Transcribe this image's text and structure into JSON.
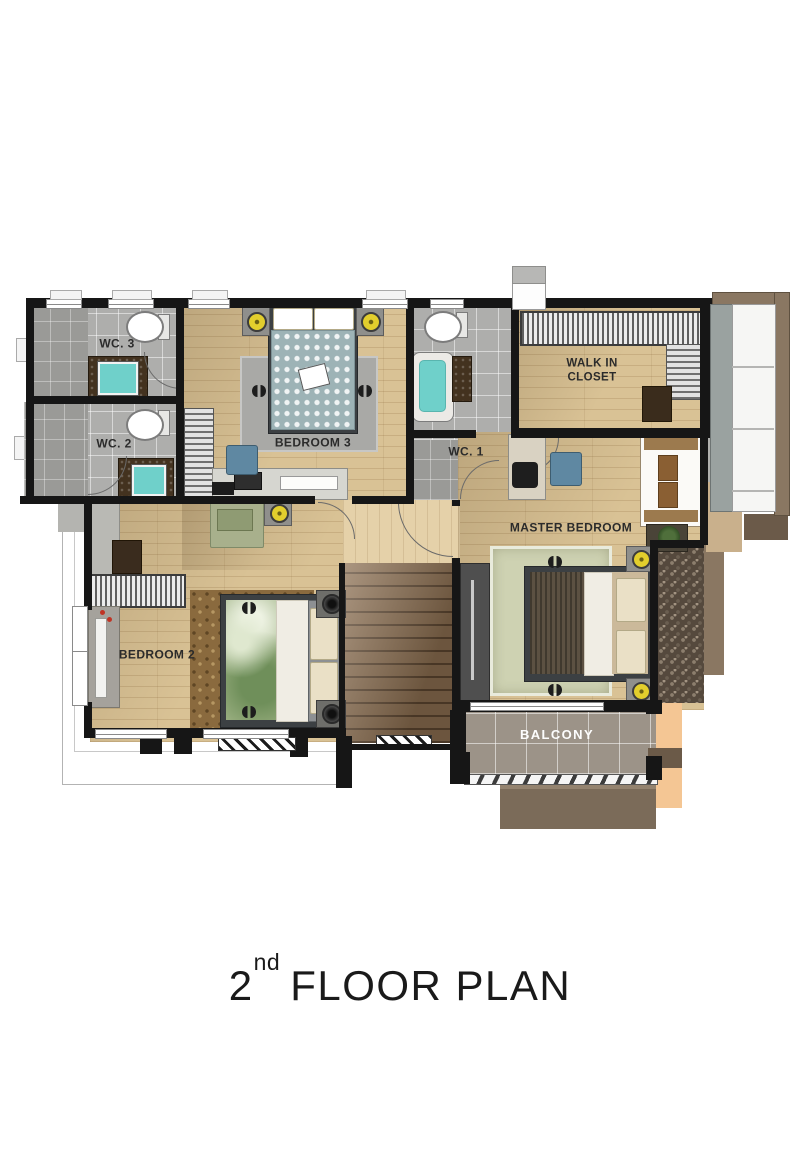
{
  "title": {
    "number": "2",
    "ordinal": "nd",
    "text": "FLOOR PLAN"
  },
  "rooms": {
    "wc3": {
      "label": "WC. 3"
    },
    "wc2": {
      "label": "WC. 2"
    },
    "bedroom3": {
      "label": "BEDROOM 3"
    },
    "wc1": {
      "label": "WC. 1"
    },
    "walk_in_closet": {
      "label": "WALK IN\nCLOSET"
    },
    "master_bedroom": {
      "label": "MASTER BEDROOM"
    },
    "bedroom2": {
      "label": "BEDROOM 2"
    },
    "balcony": {
      "label": "BALCONY"
    }
  },
  "colors": {
    "wall": "#161616",
    "wood_floor": "#d9c295",
    "wood_light": "#e5d1a9",
    "tile_gray": "#aeaeac",
    "sink_teal": "#6fd0ca",
    "vanity_brown": "#43321f",
    "duvet_teal": "#9db3b6",
    "duvet_brown": "#5c5142",
    "duvet_green": "#9eb284",
    "rug_gray": "#a9a9a6",
    "rug_sage": "#ced2b2",
    "rug_brown": "#8a6a3e",
    "speaker_yellow": "#e2ce2d",
    "stair_brown": "#8a6d4f",
    "balcony_tile": "#9c9388",
    "roof_brown": "#7b6b59",
    "peach": "#f4c694",
    "bay_frame_brown": "#8a7762",
    "chair_blue": "#5f88a2",
    "label_dark": "#2b2b2b",
    "title_color": "#1a1a1a"
  }
}
